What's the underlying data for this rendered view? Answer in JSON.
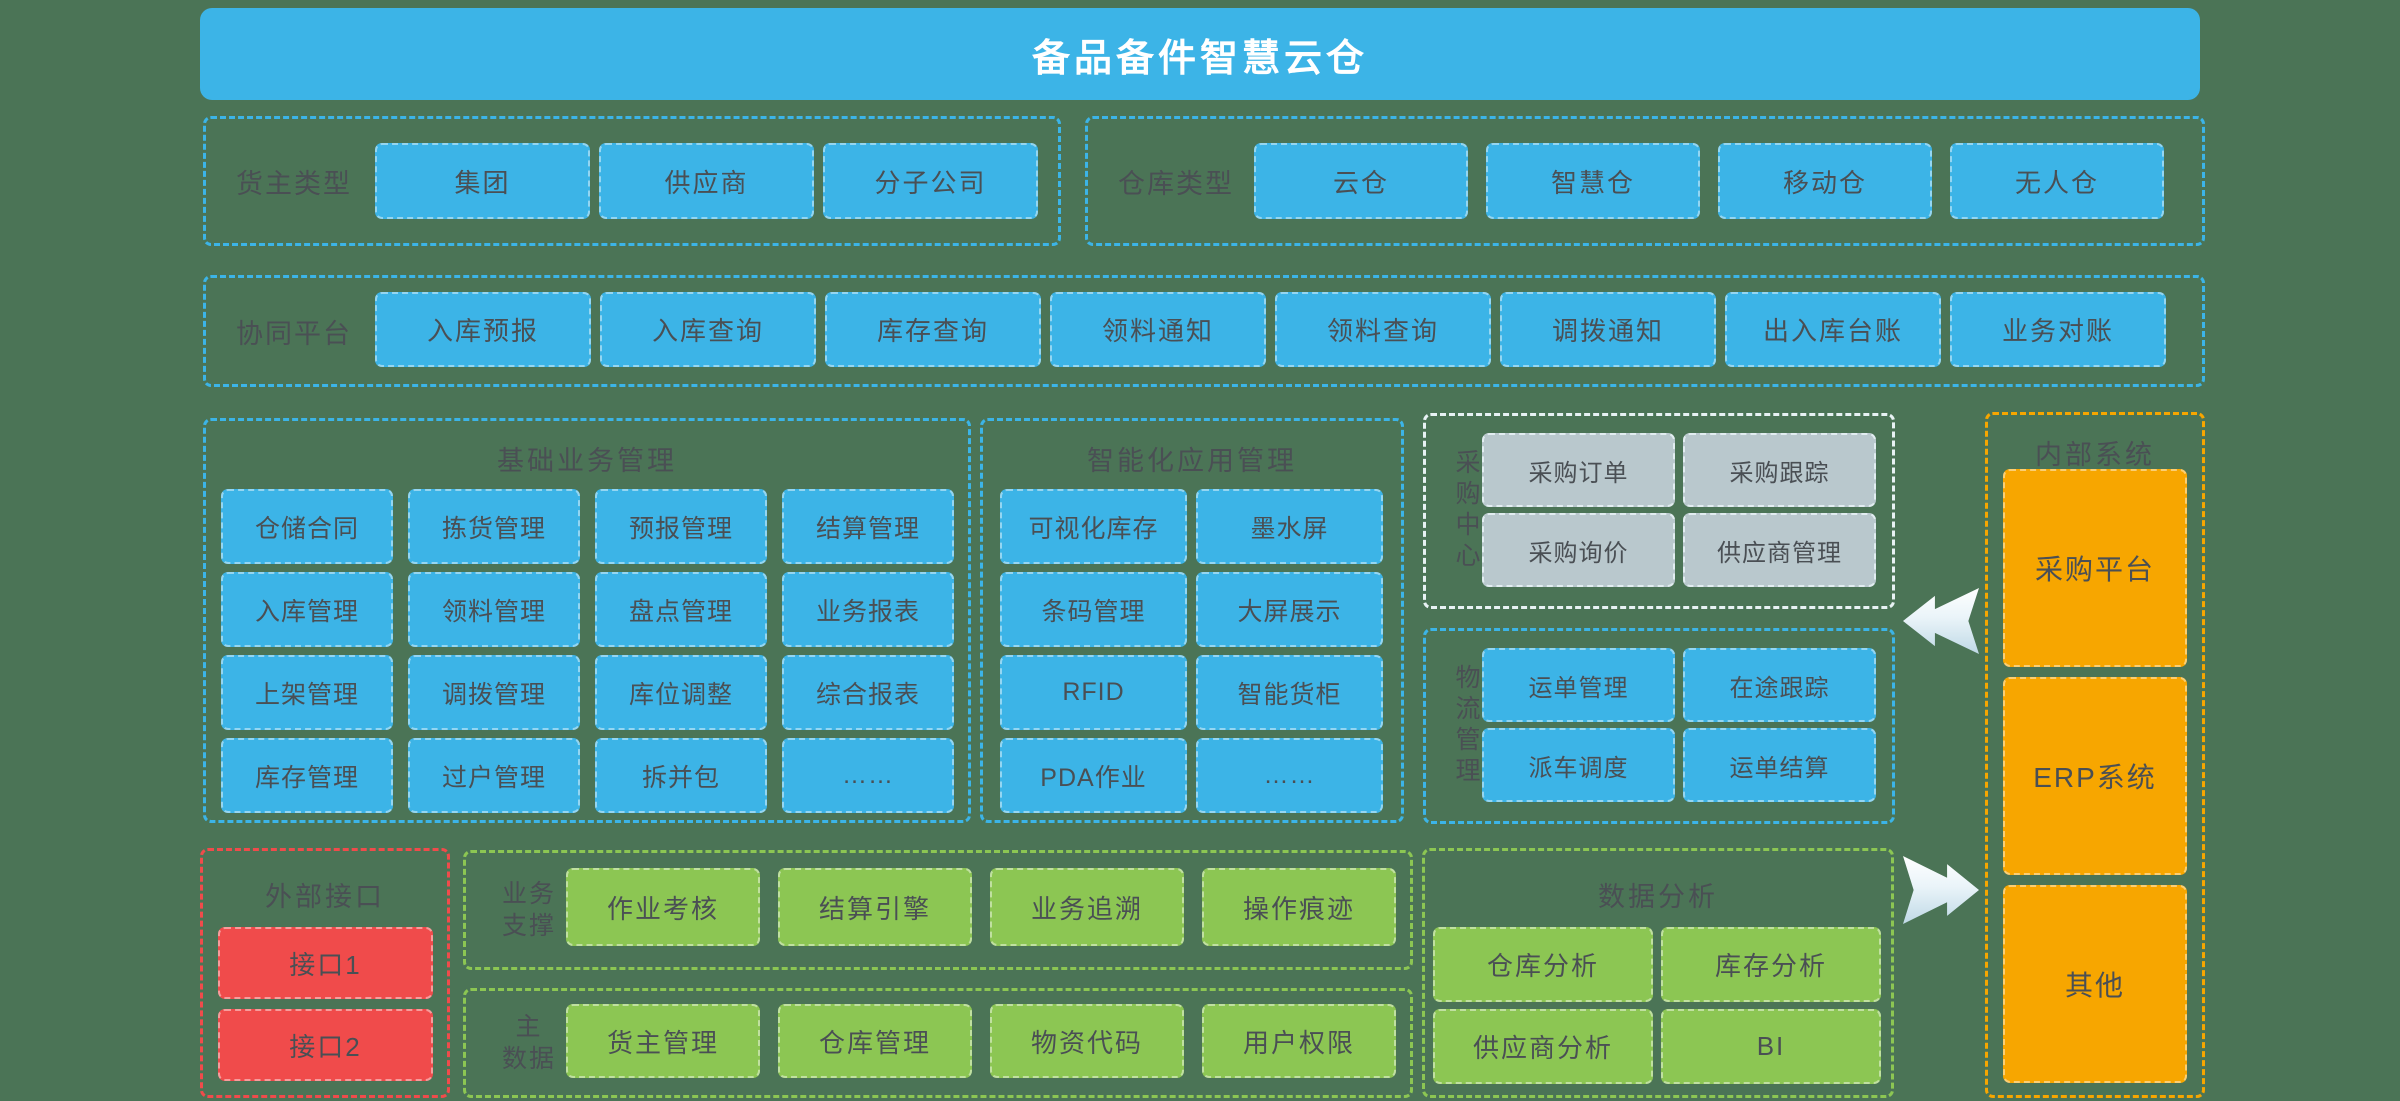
{
  "title": "备品备件智慧云仓",
  "owner_type": {
    "label": "货主类型",
    "items": [
      "集团",
      "供应商",
      "分子公司"
    ]
  },
  "warehouse_type": {
    "label": "仓库类型",
    "items": [
      "云仓",
      "智慧仓",
      "移动仓",
      "无人仓"
    ]
  },
  "collab_platform": {
    "label": "协同平台",
    "items": [
      "入库预报",
      "入库查询",
      "库存查询",
      "领料通知",
      "领料查询",
      "调拨通知",
      "出入库台账",
      "业务对账"
    ]
  },
  "basic_business": {
    "title": "基础业务管理",
    "items": [
      "仓储合同",
      "拣货管理",
      "预报管理",
      "结算管理",
      "入库管理",
      "领料管理",
      "盘点管理",
      "业务报表",
      "上架管理",
      "调拨管理",
      "库位调整",
      "综合报表",
      "库存管理",
      "过户管理",
      "拆并包",
      "……"
    ]
  },
  "smart_app": {
    "title": "智能化应用管理",
    "items": [
      "可视化库存",
      "墨水屏",
      "条码管理",
      "大屏展示",
      "RFID",
      "智能货柜",
      "PDA作业",
      "……"
    ]
  },
  "procurement_center": {
    "label": "采购中心",
    "items": [
      "采购订单",
      "采购跟踪",
      "采购询价",
      "供应商管理"
    ]
  },
  "logistics": {
    "label": "物流管理",
    "items": [
      "运单管理",
      "在途跟踪",
      "派车调度",
      "运单结算"
    ]
  },
  "internal_systems": {
    "title": "内部系统",
    "items": [
      "采购平台",
      "ERP系统",
      "其他"
    ]
  },
  "external_interface": {
    "title": "外部接口",
    "items": [
      "接口1",
      "接口2"
    ]
  },
  "business_support": {
    "label_lines": [
      "业务",
      "支撑"
    ],
    "items": [
      "作业考核",
      "结算引擎",
      "业务追溯",
      "操作痕迹"
    ]
  },
  "master_data": {
    "label_lines": [
      "主",
      "数据"
    ],
    "items": [
      "货主管理",
      "仓库管理",
      "物资代码",
      "用户权限"
    ]
  },
  "data_analysis": {
    "title": "数据分析",
    "items": [
      "仓库分析",
      "库存分析",
      "供应商分析",
      "BI"
    ]
  },
  "colors": {
    "background": "#4B7456",
    "accent_blue": "#3CB4E7",
    "green": "#8CC653",
    "orange": "#F7A600",
    "red": "#F04B4B",
    "gray": "#B9C8CD",
    "text_dark": "#4A4F54"
  }
}
